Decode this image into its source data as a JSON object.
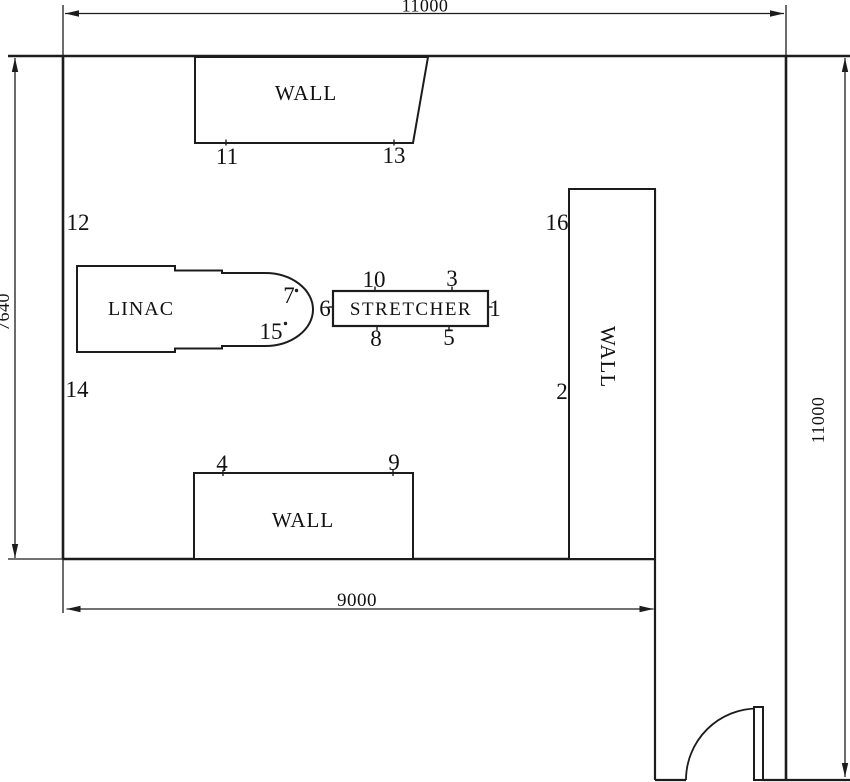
{
  "diagram": {
    "type": "floor-plan",
    "dimensions": {
      "top": "11000",
      "right": "11000",
      "left": "7640",
      "bottom": "9000"
    },
    "labels": {
      "top_wall": "WALL",
      "right_wall": "WALL",
      "bottom_wall": "WALL",
      "linac": "LINAC",
      "stretcher": "STRETCHER"
    },
    "point_labels": [
      "1",
      "2",
      "3",
      "4",
      "5",
      "6",
      "7",
      "8",
      "9",
      "10",
      "11",
      "12",
      "13",
      "14",
      "15",
      "16"
    ],
    "colors": {
      "line": "#1c1c1c",
      "background": "#ffffff"
    }
  }
}
